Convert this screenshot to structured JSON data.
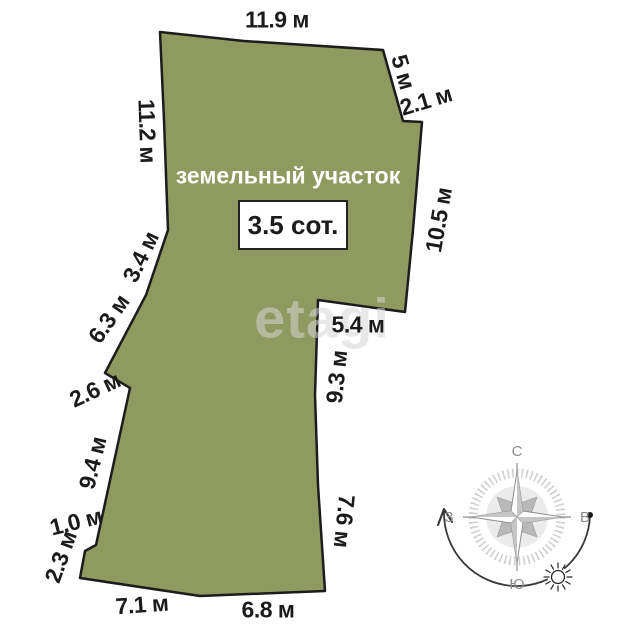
{
  "plot": {
    "name": "земельный участок",
    "area_label": "3.5 сот."
  },
  "dimensions": [
    {
      "label": "11.9 м",
      "side": "top"
    },
    {
      "label": "5 м",
      "side": "top-right-slant"
    },
    {
      "label": "2.1 м",
      "side": "top-right-notch"
    },
    {
      "label": "10.5 м",
      "side": "right-upper"
    },
    {
      "label": "5.4 м",
      "side": "right-step"
    },
    {
      "label": "9.3 м",
      "side": "right-middle"
    },
    {
      "label": "7.6 м",
      "side": "right-lower"
    },
    {
      "label": "6.8 м",
      "side": "bottom-right"
    },
    {
      "label": "7.1 м",
      "side": "bottom-left"
    },
    {
      "label": "2.3 м",
      "side": "left-bottom"
    },
    {
      "label": "1.0 м",
      "side": "left-bottom-notch"
    },
    {
      "label": "9.4 м",
      "side": "left-lower"
    },
    {
      "label": "2.6 м",
      "side": "left-step"
    },
    {
      "label": "6.3 м",
      "side": "left-middle"
    },
    {
      "label": "3.4 м",
      "side": "left-upper-middle"
    },
    {
      "label": "11.2 м",
      "side": "left-upper"
    }
  ],
  "compass": {
    "north": "С",
    "south": "Ю",
    "west": "З",
    "east": "В"
  },
  "watermark": {
    "text": "etagi"
  },
  "colors": {
    "plot_fill": "#8F9A60",
    "plot_outline": "#1c1c1c",
    "dimension_text": "#1b1b1b",
    "compass_gray": "#8d8d8d",
    "watermark_gray": "#d6d6d6"
  }
}
